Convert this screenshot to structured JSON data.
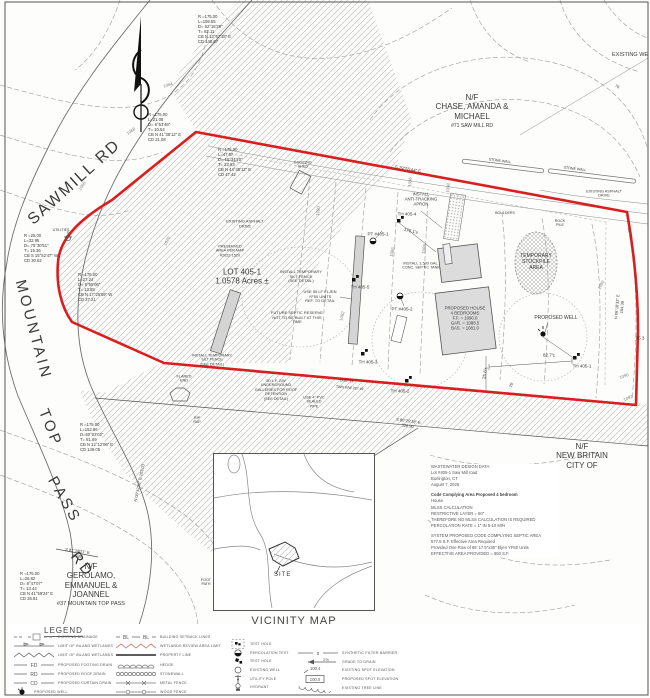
{
  "colors": {
    "boundary_red": "#d81e1e",
    "hatch_gray": "#bfbfbf",
    "contour_gray": "#9a9a9a",
    "building_fill": "#dcdcdc",
    "wetland_red": "#d98880"
  },
  "vicinity": {
    "title": "VICINITY MAP",
    "scale": "SCALE: 1\"=1000'",
    "site_label": "SITE"
  },
  "notes": {
    "hatch_note": "HATCH DEPICTS 'PRESERVED\nAREA' AS DEPICTED ON MAP\n2022-1520 ON FILE IN THE\nBURLINGTON LAND RECORDS",
    "watermark": "SmartMLS, Inc. 2025",
    "wastewater": [
      {
        "t": "WASTEWATER DESIGN DATA:",
        "b": false
      },
      {
        "t": "Lot #405-1 Saw Mill road",
        "b": false
      },
      {
        "t": "Burlington, CT",
        "b": false
      },
      {
        "t": "August 7, 2025",
        "b": false
      },
      {
        "t": "",
        "b": false
      },
      {
        "t": "Code Complying Area Proposed 4 bedroom",
        "b": true
      },
      {
        "t": "House",
        "b": false
      },
      {
        "t": "MLSS CALCULATION",
        "b": false
      },
      {
        "t": "RESTRICTIVE LAYER = 60\"",
        "b": false
      },
      {
        "t": "THEREFORE NO MLSS CALCULATION IS REQUIRED",
        "b": false
      },
      {
        "t": "PERCOLATION RATE = 1\" IN 5-10 MIN",
        "b": false
      },
      {
        "t": "",
        "b": false
      },
      {
        "t": "SYSTEM PROPOSED CODE COMPLYING SEPTIC AREA",
        "b": false
      },
      {
        "t": "577.5 S.F. Effective Area Required",
        "b": false
      },
      {
        "t": "Provided One Row of 65' 17.5\"x36\" Eljen YF50 Units",
        "b": false
      },
      {
        "t": "EFFECTIVE AREA PROVIDED = 650 S.F.",
        "b": false
      }
    ]
  },
  "map_labels": [
    {
      "t": "SAWMILL RD",
      "x": 75,
      "y": 183,
      "r": -42,
      "s": 16,
      "ls": 2
    },
    {
      "t": "MOUNTAIN",
      "x": 33,
      "y": 330,
      "r": 75,
      "s": 15,
      "ls": 3
    },
    {
      "t": "TOP",
      "x": 50,
      "y": 428,
      "r": 68,
      "s": 15,
      "ls": 3
    },
    {
      "t": "PASS",
      "x": 64,
      "y": 500,
      "r": 60,
      "s": 15,
      "ls": 3
    },
    {
      "t": "RD",
      "x": 82,
      "y": 565,
      "r": 52,
      "s": 15,
      "ls": 3
    },
    {
      "t": "R =175.00\nL=159.55\nD= 52°16'29\"\nT= 82.11\nCB N 12°57'18\" E\nCD 148.67",
      "x": 198,
      "y": 30,
      "s": 4.2,
      "a": "l"
    },
    {
      "t": "R =175.00\nL=21.08\nD= 6°53'46\"\nT= 10.54\nCB N 41°38'12\" E\nCD 21.08",
      "x": 148,
      "y": 128,
      "s": 4.2,
      "a": "l"
    },
    {
      "t": "R =175.00\nL=47.57\nD= 15°34'20\"\nT= 23.93\nCB N 44°45'12\" E\nCD 47.42",
      "x": 218,
      "y": 163,
      "s": 4.2,
      "a": "l"
    },
    {
      "t": "R =25.00\nL=32.95\nD= 75°30'51\"\nT= 19.36\nCB S 15°52'47\" W\nCD 30.62",
      "x": 24,
      "y": 249,
      "s": 4.2,
      "a": "l"
    },
    {
      "t": "R =175.00\nL=27.24\nD= 8°55'06\"\nT= 13.65\nCB N 17°25'59\" W\nCD 27.21",
      "x": 78,
      "y": 288,
      "s": 4.2,
      "a": "l"
    },
    {
      "t": "R =175.00\nL=26.82\nD= 8°47'07\"\nT= 13.44\nCB N 41°59'24\" E\nCD 26.81",
      "x": 20,
      "y": 587,
      "s": 4.2,
      "a": "l"
    },
    {
      "t": "R =175.00\nL=152.86\nD=50°03'02\"\nT= 81.69\nCB N 12°12'06\" E\nCD 149.05",
      "x": 80,
      "y": 438,
      "s": 4.2,
      "a": "l"
    },
    {
      "t": "N/F\nCHASE, AMANDA &\nMICHAEL",
      "x": 472,
      "y": 107,
      "s": 8
    },
    {
      "t": "#71 SAW MILL RD",
      "x": 472,
      "y": 127,
      "s": 5
    },
    {
      "t": "EXISTING WE",
      "x": 612,
      "y": 55,
      "s": 5.5,
      "a": "l"
    },
    {
      "t": "N/F\nNEW BRITAIN CITY OF",
      "x": 582,
      "y": 456,
      "s": 8
    },
    {
      "t": "N/F\nGEROLAMO,\nEMMANUEL &\nJOANNEL",
      "x": 91,
      "y": 581,
      "s": 8
    },
    {
      "t": "#37 MOUNTAIN TOP PASS",
      "x": 91,
      "y": 604,
      "s": 5.5
    },
    {
      "t": "LOT 405-1\n1.0578 Acres ±",
      "x": 242,
      "y": 277,
      "s": 8
    },
    {
      "t": "EXISTING ASPHALT\nDRIVE",
      "x": 245,
      "y": 224,
      "s": 4
    },
    {
      "t": "PRESERVED\nAREA PER MAP\n#2022-1520",
      "x": 230,
      "y": 251,
      "s": 3.8
    },
    {
      "t": "INSTALL\nANTI-TRACKING\nAPRON",
      "x": 421,
      "y": 200,
      "s": 4.2
    },
    {
      "t": "TH 405-4",
      "x": 407,
      "y": 214,
      "s": 4.5
    },
    {
      "t": "175.1'±",
      "x": 411,
      "y": 231,
      "r": 12,
      "s": 4.5
    },
    {
      "t": "EXISTING\nSHED",
      "x": 303,
      "y": 165,
      "s": 3.8
    },
    {
      "t": "STONE WALL",
      "x": 500,
      "y": 161,
      "r": 7,
      "s": 3.6
    },
    {
      "t": "STONE WALL",
      "x": 575,
      "y": 169,
      "r": 7,
      "s": 3.6
    },
    {
      "t": "EXISTING ASPHALT\nDRIVE",
      "x": 604,
      "y": 194,
      "s": 3.8
    },
    {
      "t": "BOULDERS",
      "x": 505,
      "y": 213,
      "s": 3.6
    },
    {
      "t": "ROCK\nPILE",
      "x": 560,
      "y": 223,
      "s": 3.6
    },
    {
      "t": "PT #405-1",
      "x": 378,
      "y": 234,
      "s": 4.5
    },
    {
      "t": "TH 405-5",
      "x": 360,
      "y": 287,
      "s": 4.5
    },
    {
      "t": "PT #405-2",
      "x": 402,
      "y": 309,
      "s": 4.5
    },
    {
      "t": "TH 405-3",
      "x": 368,
      "y": 362,
      "s": 4.5
    },
    {
      "t": "TH 405-2",
      "x": 400,
      "y": 391,
      "s": 4.5
    },
    {
      "t": "TH 405-1",
      "x": 582,
      "y": 366,
      "s": 4.5
    },
    {
      "t": "82.7'±",
      "x": 549,
      "y": 355,
      "s": 4.5
    },
    {
      "t": "25.6'±",
      "x": 485,
      "y": 373,
      "r": -80,
      "s": 4.5
    },
    {
      "t": "35.3",
      "x": 640,
      "y": 338,
      "s": 4.5
    },
    {
      "t": "PROPOSED WELL",
      "x": 556,
      "y": 319,
      "s": 5
    },
    {
      "t": "TEMPORARY\nSTOCKPILE\nAREA",
      "x": 536,
      "y": 263,
      "s": 5
    },
    {
      "t": "PROPOSED HOUSE\n4 BEDROOMS\nF.F. = 1090.0\nGAR. = 1088.5\nBAS. = 1081.0",
      "x": 465,
      "y": 318,
      "s": 4.3
    },
    {
      "t": "INSTALL 1,500 GAL.\nCONC. SEPTIC TANK",
      "x": 421,
      "y": 266,
      "s": 3.8
    },
    {
      "t": "INSTALL TEMPORARY\nSILT FENCE\n(SEE DETAIL)",
      "x": 301,
      "y": 277,
      "s": 4
    },
    {
      "t": "USE 55 LF ELJEN\nYF50 UNITS\nREF. TO DETAIL",
      "x": 320,
      "y": 297,
      "s": 4
    },
    {
      "t": "FUTURE SEPTIC RESERVE\nNOT TO BE BUILT AT THIS\nTIME",
      "x": 297,
      "y": 318,
      "s": 4
    },
    {
      "t": "INSTALL TEMPORARY\nSILT FENCE\n(SEE DETAIL)",
      "x": 212,
      "y": 360,
      "s": 3.8
    },
    {
      "t": "FLARED\nEND",
      "x": 184,
      "y": 379,
      "s": 3.8
    },
    {
      "t": "RIP\nRAP",
      "x": 197,
      "y": 420,
      "s": 3.6
    },
    {
      "t": "50 L.F. 2/W\nUNDERGROUND\nGALLERIES FOR ROOF\nDETENTION\n(SEE DETAIL)",
      "x": 276,
      "y": 390,
      "s": 3.8
    },
    {
      "t": "USE 4\" PVC\nSEALED\nPIPE",
      "x": 314,
      "y": 402,
      "s": 3.8
    },
    {
      "t": "UTILITIES",
      "x": 61,
      "y": 230,
      "s": 3.6
    },
    {
      "t": "S 79°55'44\" E",
      "x": 408,
      "y": 169,
      "r": 10,
      "s": 4.3
    },
    {
      "t": "S 81°18'21\" E\n59.88",
      "x": 77,
      "y": 554,
      "r": 8,
      "s": 4
    },
    {
      "t": "N 06°42'52\" E  103.03",
      "x": 140,
      "y": 483,
      "r": -78,
      "s": 4
    },
    {
      "t": "S 80°29'18\" E\n326.90",
      "x": 408,
      "y": 424,
      "r": 8,
      "s": 4
    },
    {
      "t": "N 06°18'32\" E  164.38",
      "x": 620,
      "y": 307,
      "r": -85,
      "s": 4
    },
    {
      "t": "DIST. 14'",
      "x": 347,
      "y": 381,
      "r": 5,
      "s": 3.5
    },
    {
      "t": "TWN R/W 297.49'",
      "x": 350,
      "y": 388,
      "r": 5,
      "s": 3.5
    },
    {
      "t": "75'",
      "x": 512,
      "y": 385,
      "r": -75,
      "s": 4
    },
    {
      "t": "76",
      "x": 617,
      "y": 87,
      "r": 25,
      "s": 4
    },
    {
      "t": "FOOT\nPATH",
      "x": 206,
      "y": 582,
      "s": 3.6
    },
    {
      "t": "1064",
      "x": 168,
      "y": 85,
      "r": -15,
      "s": 4.3,
      "c": "#808080"
    },
    {
      "t": "1066",
      "x": 131,
      "y": 131,
      "r": -35,
      "s": 4.3,
      "c": "#808080"
    },
    {
      "t": "1068",
      "x": 82,
      "y": 186,
      "r": -55,
      "s": 4.3,
      "c": "#808080"
    },
    {
      "t": "1070",
      "x": 167,
      "y": 241,
      "r": -60,
      "s": 4.3,
      "c": "#808080"
    },
    {
      "t": "1080",
      "x": 318,
      "y": 211,
      "r": -85,
      "s": 4.3,
      "c": "#808080"
    },
    {
      "t": "1082",
      "x": 342,
      "y": 316,
      "r": -75,
      "s": 4.3,
      "c": "#808080"
    },
    {
      "t": "1086",
      "x": 392,
      "y": 252,
      "r": -80,
      "s": 4.3,
      "c": "#808080"
    },
    {
      "t": "1088",
      "x": 424,
      "y": 249,
      "r": -80,
      "s": 4.3,
      "c": "#808080"
    },
    {
      "t": "1090",
      "x": 601,
      "y": 285,
      "r": -60,
      "s": 4.3,
      "c": "#808080"
    },
    {
      "t": "1090",
      "x": 624,
      "y": 376,
      "r": -20,
      "s": 4.3,
      "c": "#808080"
    },
    {
      "t": "1092",
      "x": 628,
      "y": 398,
      "r": -25,
      "s": 4.3,
      "c": "#808080"
    },
    {
      "t": "1096",
      "x": 410,
      "y": 182,
      "r": -85,
      "s": 4.3,
      "c": "#808080"
    },
    {
      "t": "1098",
      "x": 448,
      "y": 188,
      "r": -85,
      "s": 4.3,
      "c": "#808080"
    }
  ],
  "legend": {
    "title": "LEGEND",
    "columns": [
      {
        "x": 14,
        "y": 632,
        "step": 9.3,
        "rows": [
          {
            "sym": "existing-drainage",
            "label": "EXISTING DRAINAGE"
          },
          {
            "sym": "wetlands-limit-flag",
            "label": "LIMIT OF INLAND WETLANDS"
          },
          {
            "sym": "wetlands-limit-zigzag",
            "label": "LIMIT OF INLAND WETLANDS"
          },
          {
            "sym": "abbr-line",
            "abbr": "FD",
            "label": "PROPOSED FOOTING DRAIN"
          },
          {
            "sym": "abbr-line",
            "abbr": "RD",
            "label": "PROPOSED ROOF DRAIN"
          },
          {
            "sym": "abbr-line",
            "abbr": "CD",
            "label": "PROPOSED CURTAIN DRAIN"
          },
          {
            "sym": "well-proposed",
            "label": "PROPOSED WELL"
          }
        ]
      },
      {
        "x": 116,
        "y": 632,
        "step": 9.3,
        "rows": [
          {
            "sym": "abbr-line2",
            "abbr": "BL",
            "label": "BUILDING SETBACK LINES"
          },
          {
            "sym": "zigzag-red",
            "label": "WETLANDS REVIEW AREA LIMIT"
          },
          {
            "sym": "property-line",
            "label": "PROPERTY LINE"
          },
          {
            "sym": "hedge",
            "label": "HEDGE"
          },
          {
            "sym": "stonewall",
            "label": "STONEWALL"
          },
          {
            "sym": "fence-metal",
            "label": "METAL FENCE"
          },
          {
            "sym": "fence-wood",
            "label": "WOOD FENCE"
          }
        ]
      },
      {
        "x": 230,
        "y": 640,
        "step": 8.6,
        "rows": [
          {
            "sym": "test-hole-box",
            "label": "TEST HOLE"
          },
          {
            "sym": "perc-test",
            "label": "PERCOLATION TEST"
          },
          {
            "sym": "test-hole",
            "label": "TEST HOLE"
          },
          {
            "sym": "well-existing",
            "label": "EXISTING WELL"
          },
          {
            "sym": "utility-pole",
            "label": "UTILITY POLE"
          },
          {
            "sym": "hydrant",
            "label": "HYDRANT"
          }
        ]
      },
      {
        "x": 298,
        "y": 649,
        "step": 8.6,
        "rows": [
          {
            "sym": "filter-barrier",
            "abbr": "s",
            "label": "SYNTHETIC FILTER BARRIER"
          },
          {
            "sym": "grade-to-drain",
            "abbr": "2%",
            "label": "GRADE TO DRAIN"
          },
          {
            "sym": "spot-existing",
            "abbr": "100.4",
            "label": "EXISTING SPOT ELEVATION"
          },
          {
            "sym": "spot-proposed",
            "abbr": "100.0",
            "label": "PROPOSED SPOT ELEVATION"
          },
          {
            "sym": "tree-line",
            "label": "EXISTING TREE LINE"
          }
        ]
      }
    ]
  }
}
